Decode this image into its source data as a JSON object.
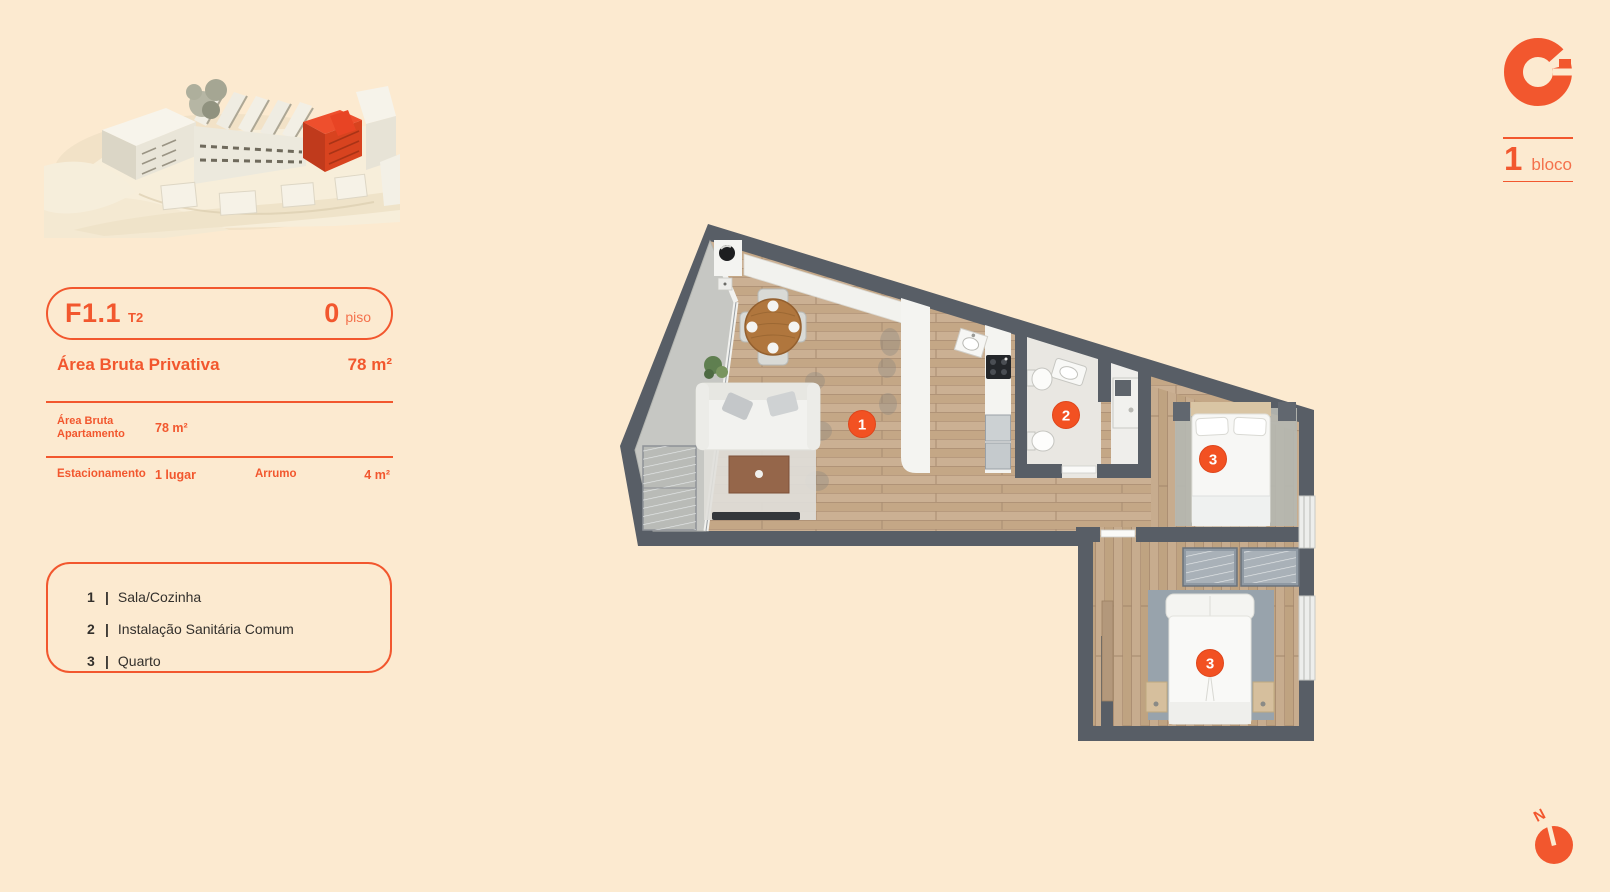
{
  "page": {
    "background": "#FCEAD0",
    "accent": "#F2572E",
    "accent_strong": "#F25122"
  },
  "unit_header": {
    "code": "F1.1",
    "typology": "T2",
    "floor_value": "0",
    "floor_label": "piso"
  },
  "area_summary": {
    "label": "Área Bruta Privativa",
    "value": "78 m²"
  },
  "details": {
    "row1_label_line1": "Área Bruta",
    "row1_label_line2": "Apartamento",
    "row1_value": "78 m²",
    "row2_label": "Estacionamento",
    "row2_value": "1 lugar",
    "row2_label2": "Arrumo",
    "row2_value2": "4 m²"
  },
  "legend": {
    "items": [
      {
        "num": "1",
        "sep": "|",
        "name": "Sala/Cozinha"
      },
      {
        "num": "2",
        "sep": "|",
        "name": "Instalação Sanitária Comum"
      },
      {
        "num": "3",
        "sep": "|",
        "name": "Quarto"
      }
    ]
  },
  "block_badge": {
    "number": "1",
    "label": "bloco"
  },
  "compass": {
    "north_label": "N"
  },
  "floorplan": {
    "markers": [
      {
        "num": "1"
      },
      {
        "num": "2"
      },
      {
        "num": "3"
      },
      {
        "num": "3"
      }
    ],
    "colors": {
      "wall": "#585E66",
      "wood": "#C9AD8F",
      "balcony": "#C6C7C3",
      "bathroom": "#E9E7E2",
      "white": "#F4F4F1",
      "marker": "#F25122"
    }
  },
  "site_model": {
    "highlight_color": "#E84E2B"
  }
}
